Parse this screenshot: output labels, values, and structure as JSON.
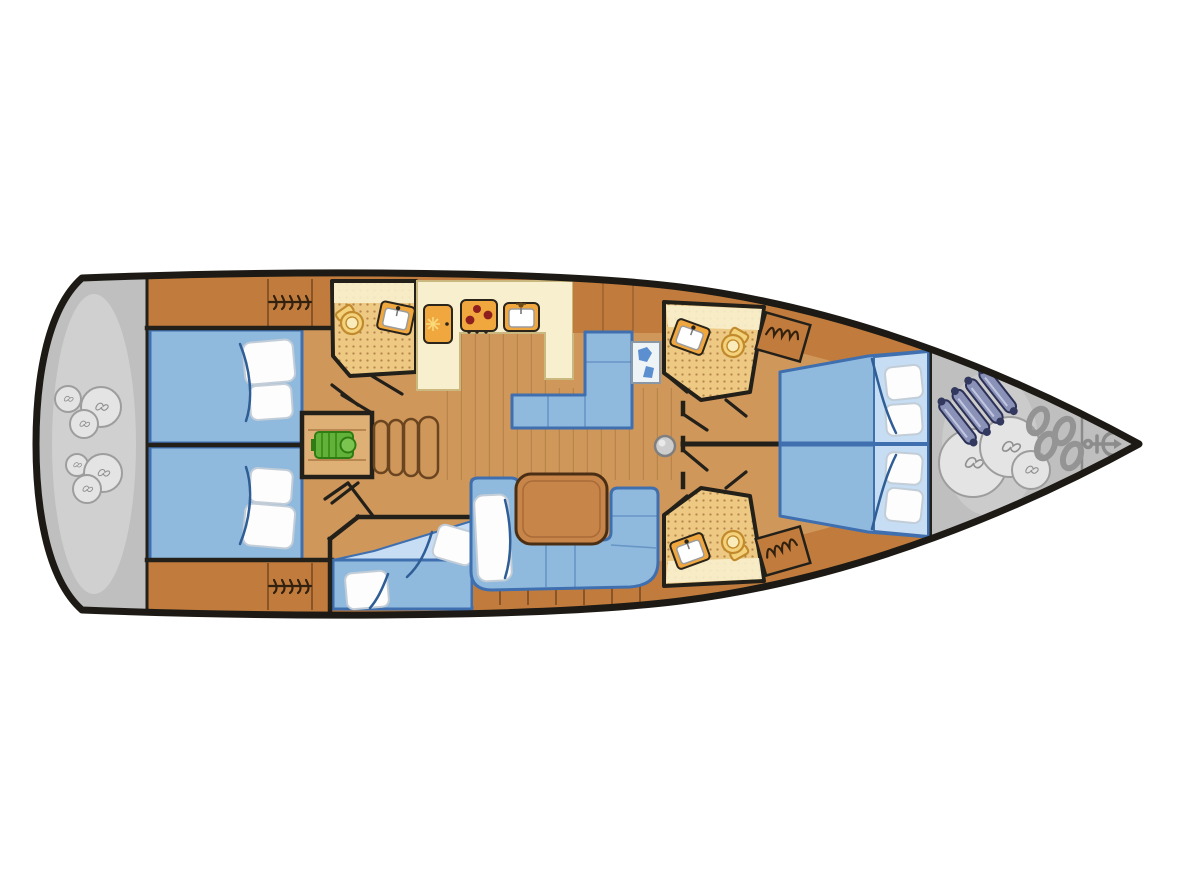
{
  "diagram": {
    "type": "yacht-deck-plan",
    "orientation": "bow-right-stern-left",
    "style": "top-down interior layout, no text labels"
  },
  "colors": {
    "hull_outline": "#1d1a15",
    "page_bg": "#ffffff",
    "deck_gray": "#bfbfbf",
    "deck_gray_light": "#d8d8d8",
    "wood_dark": "#c17c3d",
    "wood_mid": "#d0975a",
    "wood_light": "#dfb075",
    "plank_line": "#a97a42",
    "counter_cream": "#f7efcd",
    "counter_edge": "#cbb87e",
    "bed_blue": "#8fbade",
    "bed_blue_light": "#c6ddf3",
    "bed_border": "#3f6fae",
    "fold_blue": "#2f5d96",
    "pillow_white": "#fdfdfd",
    "pillow_shade": "#c2cdd8",
    "bath_floor": "#edc983",
    "bath_dot": "#b5854a",
    "fixture_orange": "#f0a73e",
    "fixture_outline": "#2a241b",
    "burner_red": "#8e1f1f",
    "engine_green": "#62b23a",
    "engine_green_dark": "#2f7d12",
    "item_gray": "#e4e4e4",
    "item_gray_stroke": "#9d9d9d",
    "fender_body": "#8b92b8",
    "fender_dark": "#33385e",
    "chain_gray": "#949494",
    "anchor_gray": "#8c8c8c",
    "wall_black": "#23201a",
    "table_wood": "#c8854a",
    "toilet_fill": "#f4d27c",
    "toilet_stroke": "#c08a2d"
  },
  "rooms": [
    {
      "id": "stern-platform",
      "items": [
        "sail-bag",
        "sail-bag",
        "sail-bag",
        "sail-bag",
        "sail-bag",
        "sail-bag"
      ]
    },
    {
      "id": "aft-cabin-port",
      "items": [
        "double-bed",
        "pillows",
        "hanging-locker"
      ]
    },
    {
      "id": "aft-cabin-starboard",
      "items": [
        "double-bed",
        "pillows",
        "hanging-locker"
      ]
    },
    {
      "id": "aft-head",
      "items": [
        "toilet",
        "washbasin"
      ]
    },
    {
      "id": "engine-compartment",
      "items": [
        "engine"
      ]
    },
    {
      "id": "companionway",
      "items": [
        "stairs"
      ]
    },
    {
      "id": "galley",
      "items": [
        "fridge",
        "stove",
        "sink",
        "u-shaped-counter"
      ]
    },
    {
      "id": "nav-station",
      "items": [
        "l-shaped-seat",
        "chart-table"
      ]
    },
    {
      "id": "salon",
      "items": [
        "u-shaped-sofa",
        "table",
        "cushion"
      ]
    },
    {
      "id": "mid-cabin-single",
      "items": [
        "berth",
        "pillows"
      ]
    },
    {
      "id": "fore-head-port",
      "items": [
        "toilet",
        "washbasin"
      ]
    },
    {
      "id": "fore-head-starboard",
      "items": [
        "toilet",
        "washbasin"
      ]
    },
    {
      "id": "fore-cabin-port",
      "items": [
        "double-bed",
        "pillows",
        "hanging-locker"
      ]
    },
    {
      "id": "fore-cabin-starboard",
      "items": [
        "double-bed",
        "pillows",
        "hanging-locker"
      ]
    },
    {
      "id": "bow-deck",
      "items": [
        "fenders",
        "sail-bag",
        "sail-bag",
        "sail-bag",
        "anchor-chain",
        "anchor",
        "anchor-locker"
      ]
    },
    {
      "id": "mast",
      "items": [
        "mast-post"
      ]
    }
  ],
  "counts": {
    "fenders": 4,
    "bow_sail_bags": 3,
    "stern_sail_bags": 6,
    "cabins": 5,
    "heads": 3
  }
}
